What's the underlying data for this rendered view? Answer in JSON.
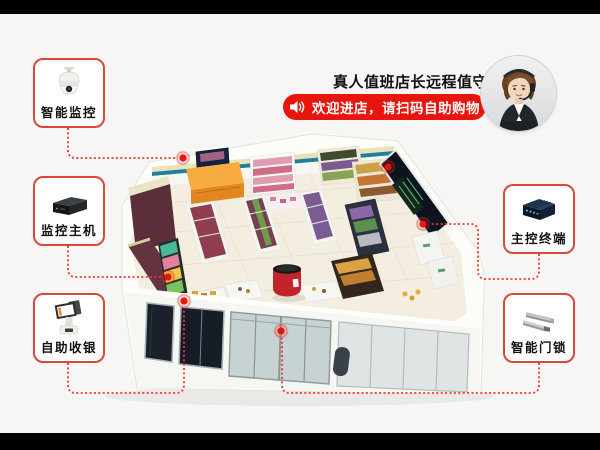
{
  "header": {
    "slogan": "真人值班店长远程值守",
    "announcement": {
      "icon": "speaker-icon",
      "text": "欢迎进店，请扫码自助购物",
      "bg_color": "#e8150d",
      "text_color": "#ffffff"
    },
    "avatar": "customer-service-agent-photo"
  },
  "callouts": [
    {
      "id": "smart-monitoring",
      "label": "智能监控",
      "icon": "dome-camera-icon",
      "side": "left"
    },
    {
      "id": "monitoring-host",
      "label": "监控主机",
      "icon": "nvr-device-icon",
      "side": "left"
    },
    {
      "id": "self-checkout",
      "label": "自助收银",
      "icon": "pos-kiosk-icon",
      "side": "left"
    },
    {
      "id": "master-terminal",
      "label": "主控终端",
      "icon": "control-terminal-icon",
      "side": "right"
    },
    {
      "id": "smart-door-lock",
      "label": "智能门锁",
      "icon": "magnetic-lock-icon",
      "side": "right"
    }
  ],
  "scene": {
    "subject": "isometric-smart-convenience-store-3d-render",
    "hotspots": 6,
    "colors": {
      "accent_red": "#e8150d",
      "callout_border": "#d8493d",
      "connector": "#e8392c",
      "background": "#f7f6f4",
      "letterbox": "#000000"
    }
  }
}
